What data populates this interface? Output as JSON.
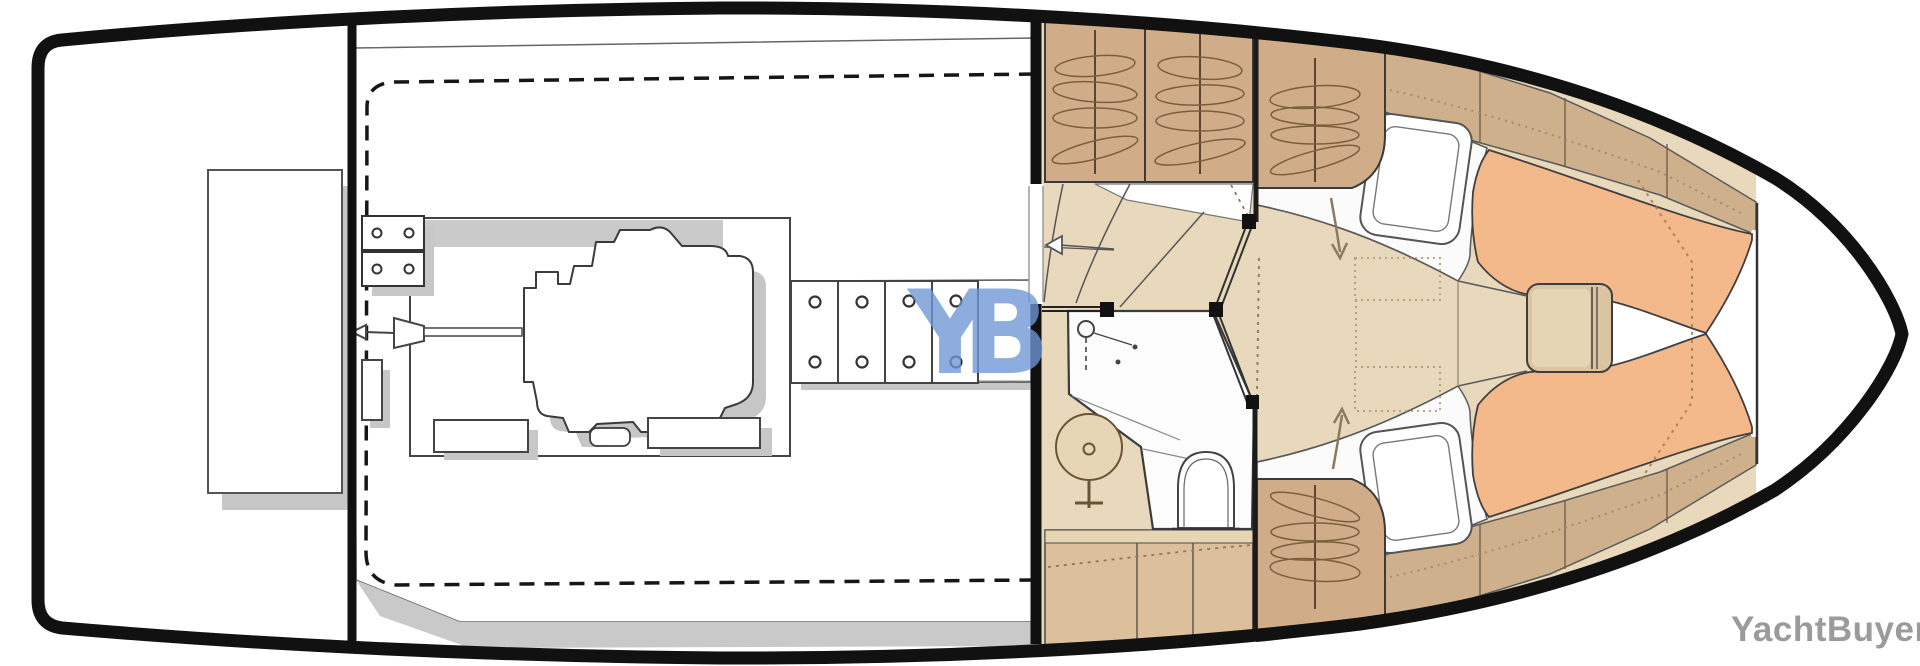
{
  "watermarks": {
    "logo": "YB",
    "brand": "YachtBuyer"
  },
  "palette": {
    "hull_outline": "#111111",
    "interior_white": "#ffffff",
    "floor_beige": "#e9d9bc",
    "furniture_tan": "#d0ad88",
    "side_deck_tan": "#cfb08c",
    "cabinet_tan": "#dcc09c",
    "cushion_orange": "#f4b98a",
    "table_tan": "#dbc5a1",
    "shadow_gray": "#c7c7c7",
    "line_dark": "#3b3b3b",
    "dotted_brown": "#a98c60",
    "logo_blue": "#6e97d7",
    "watermark_gray": "#9b9b9b"
  },
  "regions": [
    "swim-platform",
    "engine-room",
    "companionway-stairs",
    "wet-head",
    "hanging-lockers",
    "v-berth",
    "bow-locker"
  ]
}
